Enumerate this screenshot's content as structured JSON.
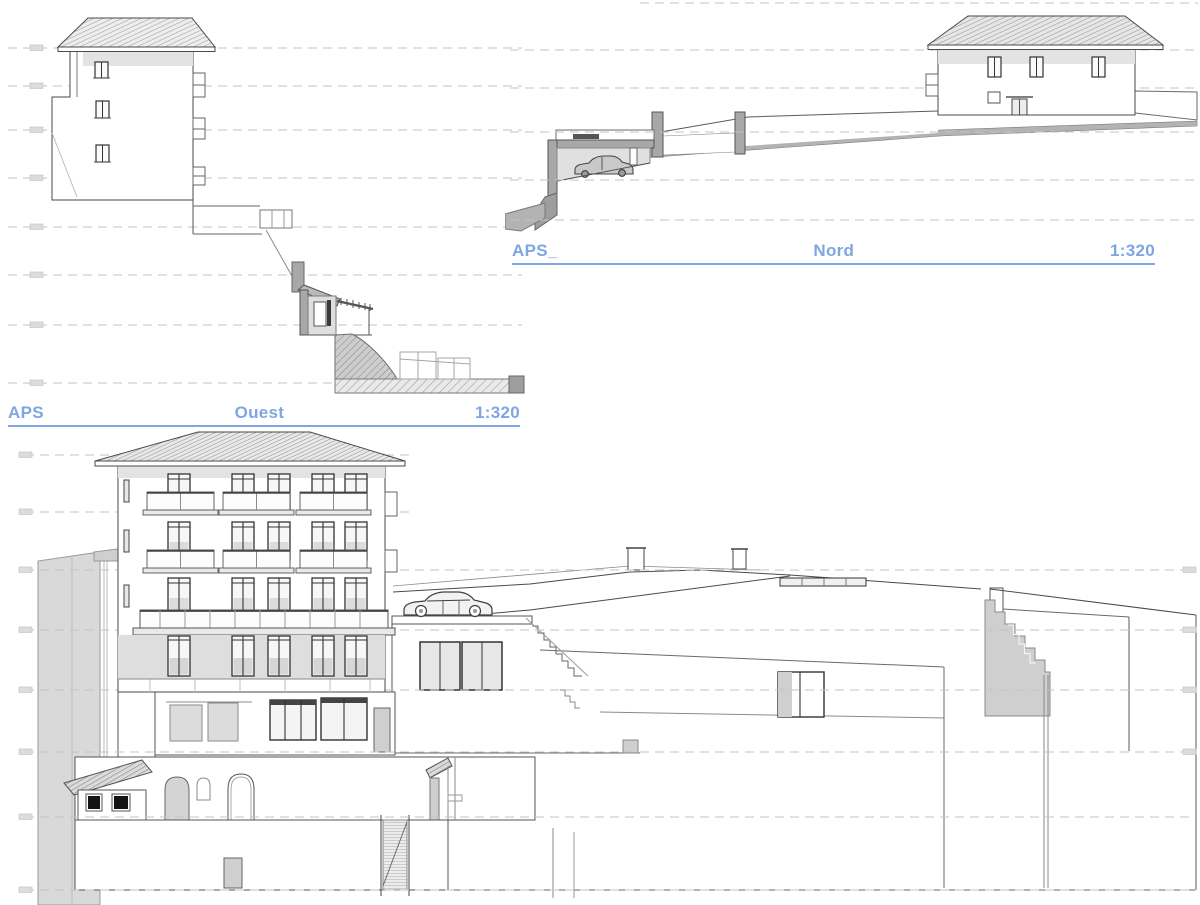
{
  "sheet": {
    "background_color": "#ffffff",
    "type": "architectural elevation sheet",
    "drawing_count": 3
  },
  "colors": {
    "title_blue": "#7ea6e3",
    "outline_dark": "#4a4a4a",
    "outline_mid": "#8a8a8a",
    "dashed_level_line": "#c3c3c3",
    "cut_wall_fill": "#a8a8a8",
    "massing_fill": "#d9d9d9",
    "glass_fill": "#dcdcdc",
    "eave_band_fill": "#e3e3e3"
  },
  "titles": {
    "ouest": {
      "prefix": "APS",
      "name": "Ouest",
      "scale": "1:320"
    },
    "nord": {
      "prefix": "APS_",
      "name": "Nord",
      "scale": "1:320"
    }
  },
  "drawings": {
    "ouest_section": {
      "description": "West section: hillside building with hipped roof, stepped terrain, annex with pergola, hatched ground",
      "level_line_y": [
        48,
        86,
        130,
        178,
        227,
        275,
        325,
        383
      ]
    },
    "nord_elevation": {
      "description": "North elevation: two-storey house with hipped roof, long retaining wall, cut garage section with car",
      "level_line_y": [
        3,
        50,
        88,
        132,
        180,
        220
      ],
      "symbols": [
        "car"
      ]
    },
    "main_elevation": {
      "description": "Large elevation: five-storey building with balconies, car on terrace deck, terraced annexes, arches, stairs",
      "level_line_y": [
        455,
        512,
        570,
        630,
        690,
        752,
        817,
        890
      ],
      "symbols": [
        "car"
      ],
      "window_columns": 5,
      "balcony_rows": 3
    }
  }
}
